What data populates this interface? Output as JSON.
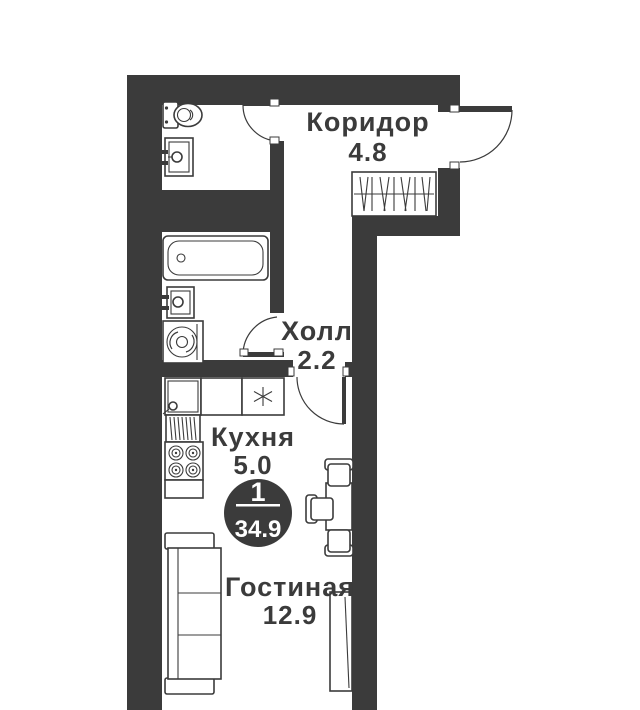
{
  "rooms": {
    "corridor": {
      "name": "Коридор",
      "area": "4.8"
    },
    "hall": {
      "name": "Холл",
      "area": "2.2"
    },
    "kitchen": {
      "name": "Кухня",
      "area": "5.0"
    },
    "living": {
      "name": "Гостиная",
      "area": "12.9"
    }
  },
  "badge": {
    "room_count": "1",
    "total_area": "34.9"
  },
  "symbols": {
    "cooktop": "✳"
  },
  "colors": {
    "wall": "#3b3b3b",
    "floor": "#ffffff",
    "badge_bg": "#3b3b3b",
    "badge_text": "#ffffff"
  },
  "fixtures": [
    "toilet",
    "washbasin",
    "bathtub",
    "washing-machine",
    "wardrobe",
    "kitchen-sink",
    "drying-rack",
    "stove",
    "dining-table",
    "chairs",
    "sofa",
    "window",
    "entrance-door"
  ]
}
